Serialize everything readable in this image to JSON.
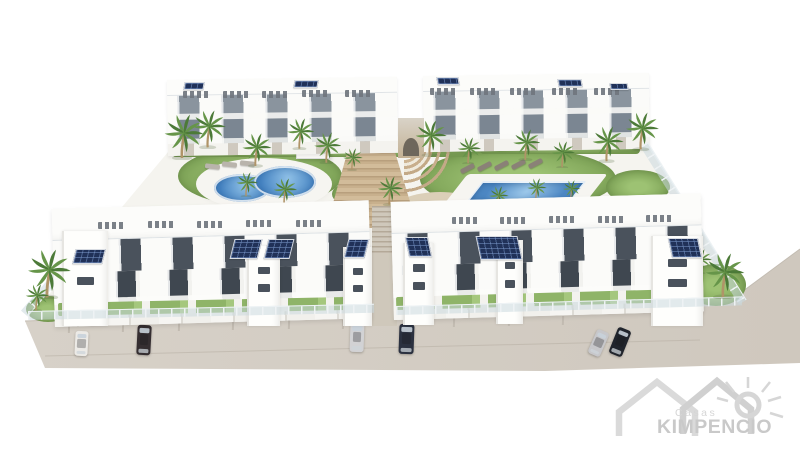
{
  "watermark": {
    "brand_top": "Casas",
    "brand_bottom": "KIMPENCIO"
  },
  "palette": {
    "background": "#ffffff",
    "street": "#d4cdc4",
    "building_white": "#fcfcfa",
    "window_glass": "#4a525c",
    "balcony_glass": "#87929c",
    "solar_blue": "#203158",
    "pool_water": "#4a86c6",
    "grass_green": "#8bb163",
    "palm_green": "#55813f",
    "stair_tan": "#c6ae8b",
    "logo_gray": "#cdcdcd"
  },
  "scene": {
    "palms": [
      [
        182,
        158,
        1.0
      ],
      [
        208,
        147,
        0.85
      ],
      [
        255,
        166,
        0.75
      ],
      [
        299,
        149,
        0.7
      ],
      [
        326,
        163,
        0.7
      ],
      [
        352,
        170,
        0.5
      ],
      [
        430,
        155,
        0.8
      ],
      [
        468,
        163,
        0.6
      ],
      [
        525,
        160,
        0.7
      ],
      [
        562,
        167,
        0.6
      ],
      [
        607,
        161,
        0.8
      ],
      [
        641,
        149,
        0.85
      ],
      [
        246,
        196,
        0.55
      ],
      [
        284,
        204,
        0.6
      ],
      [
        389,
        205,
        0.65
      ],
      [
        498,
        208,
        0.5
      ],
      [
        536,
        200,
        0.5
      ],
      [
        571,
        200,
        0.45
      ],
      [
        47,
        297,
        1.1,
        11
      ],
      [
        723,
        297,
        1.0,
        11
      ],
      [
        700,
        273,
        0.55,
        6
      ],
      [
        36,
        310,
        0.6,
        11
      ]
    ],
    "cars": [
      {
        "x": 75,
        "y": 331,
        "w": 13,
        "h": 25,
        "rot": 3,
        "color": "#eceae6"
      },
      {
        "x": 137,
        "y": 325,
        "w": 14,
        "h": 30,
        "rot": 3,
        "color": "#352e31"
      },
      {
        "x": 350,
        "y": 323,
        "w": 14,
        "h": 29,
        "rot": 2,
        "color": "#d2d2d4"
      },
      {
        "x": 399,
        "y": 324,
        "w": 15,
        "h": 30,
        "rot": 2,
        "color": "#2b3140"
      },
      {
        "x": 592,
        "y": 330,
        "w": 13,
        "h": 26,
        "rot": 24,
        "color": "#c7c7ca"
      },
      {
        "x": 613,
        "y": 328,
        "w": 14,
        "h": 28,
        "rot": 22,
        "color": "#20242c"
      }
    ],
    "solar_arrays": [
      [
        74,
        249,
        30,
        15,
        -14
      ],
      [
        232,
        239,
        28,
        20,
        -14
      ],
      [
        266,
        239,
        26,
        20,
        -14
      ],
      [
        346,
        239,
        21,
        19,
        -14
      ],
      [
        407,
        237,
        23,
        20,
        12
      ],
      [
        478,
        236,
        42,
        24,
        12
      ],
      [
        670,
        238,
        30,
        20,
        12
      ],
      [
        184,
        82,
        20,
        8,
        -10
      ],
      [
        294,
        80,
        24,
        8,
        -10
      ],
      [
        437,
        77,
        22,
        8,
        10
      ],
      [
        558,
        79,
        24,
        8,
        10
      ],
      [
        610,
        83,
        18,
        7,
        10
      ]
    ],
    "roof_furniture": [
      [
        183,
        91
      ],
      [
        223,
        91
      ],
      [
        262,
        91
      ],
      [
        302,
        90
      ],
      [
        345,
        90
      ],
      [
        430,
        88
      ],
      [
        470,
        88
      ],
      [
        510,
        88
      ],
      [
        552,
        88
      ],
      [
        594,
        88
      ],
      [
        98,
        222
      ],
      [
        148,
        221
      ],
      [
        197,
        221
      ],
      [
        246,
        220
      ],
      [
        296,
        220
      ],
      [
        452,
        217
      ],
      [
        500,
        217
      ],
      [
        549,
        216
      ],
      [
        598,
        216
      ],
      [
        646,
        215
      ]
    ],
    "loungers": [
      [
        460,
        166,
        -28,
        "#8a8177"
      ],
      [
        477,
        164,
        -28,
        "#8a8177"
      ],
      [
        494,
        163,
        -28,
        "#8a8177"
      ],
      [
        511,
        162,
        -28,
        "#8a8177"
      ],
      [
        528,
        161,
        -28,
        "#8a8177"
      ],
      [
        205,
        164,
        6,
        "#b9b4ac"
      ],
      [
        222,
        162,
        6,
        "#b9b4ac"
      ],
      [
        240,
        161,
        6,
        "#b9b4ac"
      ],
      [
        470,
        209,
        -24,
        "#ece9e3"
      ],
      [
        487,
        208,
        -24,
        "#ece9e3"
      ],
      [
        504,
        207,
        -24,
        "#ece9e3"
      ]
    ],
    "stair_towers": [
      [
        62,
        231,
        46,
        95
      ],
      [
        247,
        246,
        33,
        80
      ],
      [
        343,
        247,
        29,
        79
      ],
      [
        403,
        243,
        31,
        82
      ],
      [
        496,
        240,
        27,
        84
      ],
      [
        651,
        236,
        52,
        90
      ]
    ],
    "parking_marks": [
      [
        68,
        324
      ],
      [
        122,
        323
      ],
      [
        178,
        322
      ],
      [
        232,
        321
      ],
      [
        288,
        320
      ],
      [
        342,
        320
      ],
      [
        453,
        318
      ],
      [
        508,
        317
      ],
      [
        562,
        316
      ],
      [
        655,
        312
      ]
    ]
  }
}
